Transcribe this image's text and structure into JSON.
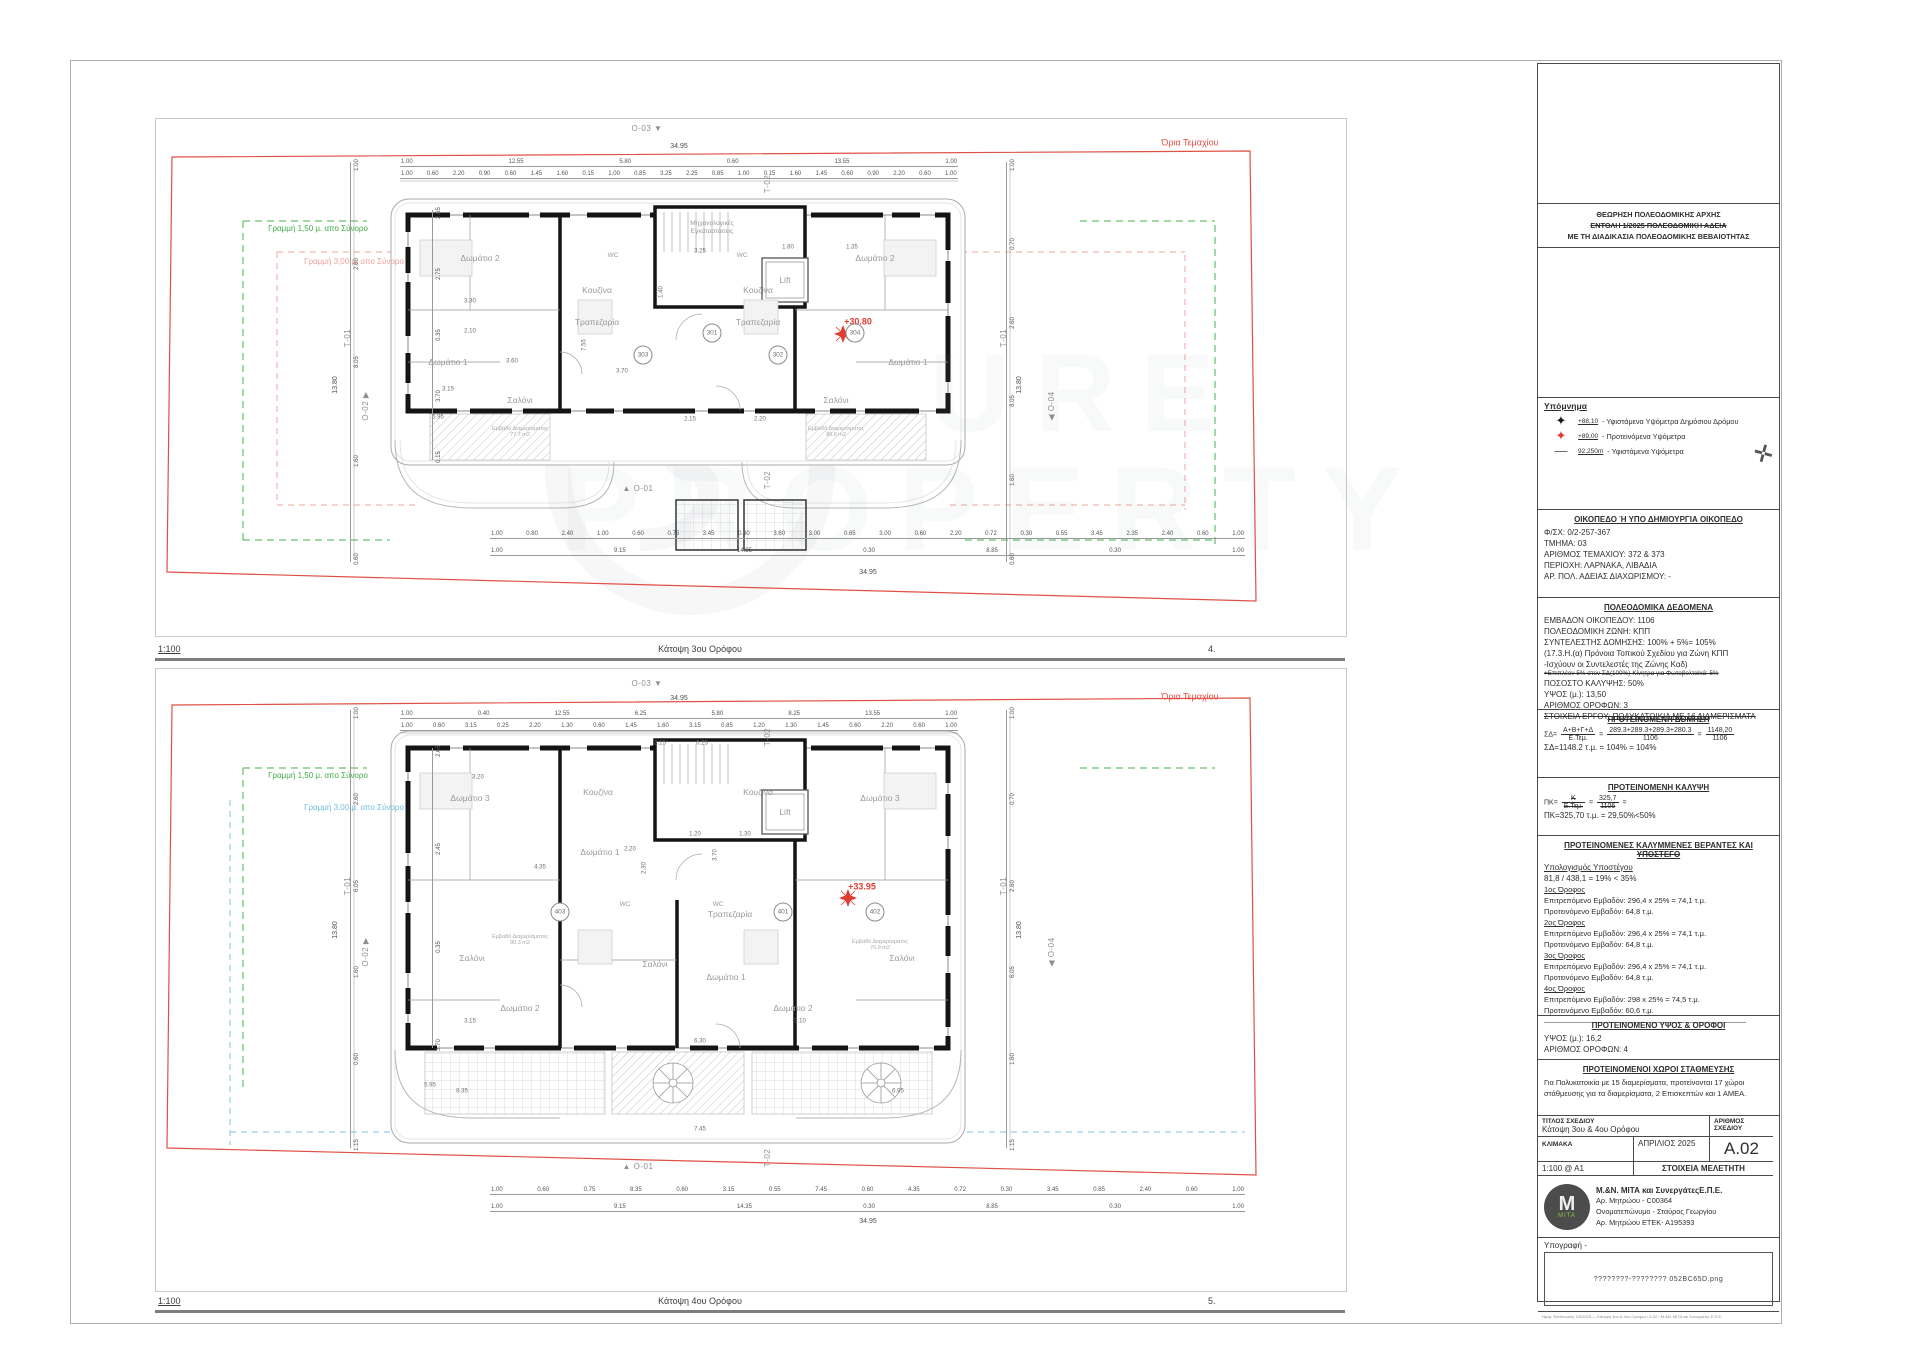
{
  "watermark": {
    "line1": "URE",
    "line2": "PROPERTY"
  },
  "captions": {
    "plan1": {
      "scale": "1:100",
      "title": "Κάτοψη 3ου Ορόφου",
      "number": "4."
    },
    "plan2": {
      "scale": "1:100",
      "title": "Κάτοψη 4ου Ορόφου",
      "number": "5."
    }
  },
  "markers": [
    {
      "t": "Ο-03  ▼",
      "x": 647,
      "y": 129
    },
    {
      "t": "Τ-02",
      "x": 768,
      "y": 184,
      "rot": -90
    },
    {
      "t": "Ο-02  ▶",
      "x": 366,
      "y": 406,
      "rot": -90
    },
    {
      "t": "Τ-01",
      "x": 348,
      "y": 338,
      "rot": -90
    },
    {
      "t": "Τ-01",
      "x": 1004,
      "y": 338,
      "rot": -90
    },
    {
      "t": "◀  Ο-04",
      "x": 1052,
      "y": 406,
      "rot": -90
    },
    {
      "t": "▲  Ο-01",
      "x": 638,
      "y": 489
    },
    {
      "t": "Τ-02",
      "x": 768,
      "y": 480,
      "rot": -90
    },
    {
      "t": "Ο-03  ▼",
      "x": 647,
      "y": 684
    },
    {
      "t": "Τ-02",
      "x": 768,
      "y": 737,
      "rot": -90
    },
    {
      "t": "Ο-02  ▶",
      "x": 366,
      "y": 952,
      "rot": -90
    },
    {
      "t": "Τ-01",
      "x": 348,
      "y": 886,
      "rot": -90
    },
    {
      "t": "Τ-01",
      "x": 1004,
      "y": 886,
      "rot": -90
    },
    {
      "t": "◀  Ο-04",
      "x": 1052,
      "y": 952,
      "rot": -90
    },
    {
      "t": "▲  Ο-01",
      "x": 638,
      "y": 1167
    },
    {
      "t": "Τ-02",
      "x": 768,
      "y": 1158,
      "rot": -90
    }
  ],
  "plan1": {
    "labels": [
      {
        "t": "Όρια Τεμαχίου",
        "x": 1190,
        "y": 143,
        "c": "redlbl"
      },
      {
        "t": "Γραμμή 1,50 μ. απο Σύνορο",
        "x": 318,
        "y": 229,
        "c": "greenlbl"
      },
      {
        "t": "Γραμμή 3,00 μ. απο Σύνορο",
        "x": 354,
        "y": 262,
        "c": "pinklbl"
      },
      {
        "t": "34.95",
        "x": 679,
        "y": 147,
        "c": "dimtot"
      },
      {
        "t": "34.95",
        "x": 868,
        "y": 573,
        "c": "dimtot"
      },
      {
        "t": "13.80",
        "x": 336,
        "y": 385,
        "c": "dimtot",
        "rot": -90
      },
      {
        "t": "13.80",
        "x": 1020,
        "y": 385,
        "c": "dimtot",
        "rot": -90
      },
      {
        "t": "Μηχανολογικές\nΕγκαταστάσεις",
        "x": 712,
        "y": 228,
        "c": "tinylbl"
      },
      {
        "t": "Lift",
        "x": 785,
        "y": 280,
        "c": "roomlbl"
      },
      {
        "t": "Δωμάτιο 2",
        "x": 480,
        "y": 258,
        "c": "roomlbl"
      },
      {
        "t": "Δωμάτιο 2",
        "x": 875,
        "y": 258,
        "c": "roomlbl"
      },
      {
        "t": "Δωμάτιο 1",
        "x": 448,
        "y": 362,
        "c": "roomlbl"
      },
      {
        "t": "Δωμάτιο 1",
        "x": 908,
        "y": 362,
        "c": "roomlbl"
      },
      {
        "t": "Κουζίνα",
        "x": 597,
        "y": 290,
        "c": "roomlbl"
      },
      {
        "t": "Κουζίνα",
        "x": 758,
        "y": 290,
        "c": "roomlbl"
      },
      {
        "t": "Τραπεζαρία",
        "x": 597,
        "y": 322,
        "c": "roomlbl"
      },
      {
        "t": "Τραπεζαρία",
        "x": 758,
        "y": 322,
        "c": "roomlbl"
      },
      {
        "t": "WC",
        "x": 613,
        "y": 256,
        "c": "tinylbl"
      },
      {
        "t": "WC",
        "x": 742,
        "y": 256,
        "c": "tinylbl"
      },
      {
        "t": "Σαλόνι",
        "x": 520,
        "y": 400,
        "c": "roomlbl"
      },
      {
        "t": "Σαλόνι",
        "x": 836,
        "y": 400,
        "c": "roomlbl"
      },
      {
        "t": "Εμβαδό Διαμερίσματος\n77.7 m2",
        "x": 520,
        "y": 432,
        "c": "arealbl"
      },
      {
        "t": "Εμβαδό Διαμερίσματος\n80.6 m2",
        "x": 836,
        "y": 432,
        "c": "arealbl"
      },
      {
        "t": "+30.80",
        "x": 858,
        "y": 322,
        "c": "levellbl"
      },
      {
        "t": "3.30",
        "x": 470,
        "y": 302,
        "c": "dimin"
      },
      {
        "t": "2.10",
        "x": 470,
        "y": 332,
        "c": "dimin"
      },
      {
        "t": "3.15",
        "x": 448,
        "y": 390,
        "c": "dimin"
      },
      {
        "t": "3.70",
        "x": 622,
        "y": 372,
        "c": "dimin"
      },
      {
        "t": "5.95",
        "x": 438,
        "y": 418,
        "c": "dimin"
      },
      {
        "t": "3.25",
        "x": 700,
        "y": 252,
        "c": "dimin"
      },
      {
        "t": "1.80",
        "x": 788,
        "y": 248,
        "c": "dimin"
      },
      {
        "t": "1.35",
        "x": 852,
        "y": 248,
        "c": "dimin"
      },
      {
        "t": "2.15",
        "x": 690,
        "y": 420,
        "c": "dimin"
      },
      {
        "t": "1.40",
        "x": 662,
        "y": 292,
        "c": "dimin",
        "rot": -90
      },
      {
        "t": "7.55",
        "x": 585,
        "y": 345,
        "c": "dimin",
        "rot": -90
      },
      {
        "t": "3.60",
        "x": 512,
        "y": 362,
        "c": "dimin"
      },
      {
        "t": "2.20",
        "x": 760,
        "y": 420,
        "c": "dimin"
      }
    ],
    "units": [
      {
        "t": "301",
        "x": 712,
        "y": 333
      },
      {
        "t": "302",
        "x": 778,
        "y": 355
      },
      {
        "t": "303",
        "x": 643,
        "y": 355
      },
      {
        "t": "304",
        "x": 855,
        "y": 333
      }
    ],
    "dimrows": [
      {
        "x": 400,
        "y": 158,
        "w": 558,
        "vals": [
          "1.00",
          "12.55",
          "5.80",
          "0.60",
          "13.55",
          "1.00"
        ]
      },
      {
        "x": 400,
        "y": 170,
        "w": 558,
        "vals": [
          "1.00",
          "0.60",
          "2.20",
          "0.90",
          "0.60",
          "1.45",
          "1.60",
          "0.15",
          "1.00",
          "0.85",
          "3.25",
          "2.25",
          "0.85",
          "1.00",
          "0.15",
          "1.60",
          "1.45",
          "0.60",
          "0.90",
          "2.20",
          "0.60",
          "1.00"
        ]
      },
      {
        "x": 490,
        "y": 530,
        "w": 755,
        "vals": [
          "1.00",
          "0.80",
          "2.40",
          "1.00",
          "0.60",
          "0.75",
          "3.45",
          "0.60",
          "3.60",
          "3.00",
          "0.65",
          "3.00",
          "0.60",
          "2.20",
          "0.72",
          "0.30",
          "0.55",
          "3.45",
          "2.35",
          "2.40",
          "0.60",
          "1.00"
        ]
      },
      {
        "x": 490,
        "y": 547,
        "w": 755,
        "vals": [
          "1.00",
          "9.15",
          "14.35",
          "0.30",
          "8.85",
          "0.30",
          "1.00"
        ]
      }
    ],
    "vdims": [
      {
        "x": 350,
        "y": 162,
        "h": 400,
        "vals": [
          "1.00",
          "2.60",
          "8.05",
          "1.60",
          "0.60"
        ]
      },
      {
        "x": 432,
        "y": 210,
        "h": 250,
        "vals": [
          "2.65",
          "2.75",
          "0.35",
          "3.70",
          "0.15"
        ]
      },
      {
        "x": 1006,
        "y": 162,
        "h": 400,
        "vals": [
          "1.00",
          "0.70",
          "2.60",
          "8.05",
          "1.60",
          "0.60"
        ]
      }
    ]
  },
  "plan2": {
    "labels": [
      {
        "t": "Όρια Τεμαχίου",
        "x": 1190,
        "y": 697,
        "c": "redlbl"
      },
      {
        "t": "Γραμμή 1,50 μ. απο Σύνορο",
        "x": 318,
        "y": 776,
        "c": "greenlbl"
      },
      {
        "t": "Γραμμή 3,00 μ. απο Σύνορο",
        "x": 354,
        "y": 808,
        "c": "bluelbl"
      },
      {
        "t": "34.95",
        "x": 679,
        "y": 699,
        "c": "dimtot"
      },
      {
        "t": "34.95",
        "x": 868,
        "y": 1222,
        "c": "dimtot"
      },
      {
        "t": "13.80",
        "x": 336,
        "y": 930,
        "c": "dimtot",
        "rot": -90
      },
      {
        "t": "13.80",
        "x": 1020,
        "y": 930,
        "c": "dimtot",
        "rot": -90
      },
      {
        "t": "Lift",
        "x": 785,
        "y": 812,
        "c": "roomlbl"
      },
      {
        "t": "Δωμάτιο 3",
        "x": 470,
        "y": 798,
        "c": "roomlbl"
      },
      {
        "t": "Δωμάτιο 3",
        "x": 880,
        "y": 798,
        "c": "roomlbl"
      },
      {
        "t": "Κουζίνα",
        "x": 598,
        "y": 792,
        "c": "roomlbl"
      },
      {
        "t": "Κουζίνα",
        "x": 758,
        "y": 792,
        "c": "roomlbl"
      },
      {
        "t": "Τραπεζαρία",
        "x": 730,
        "y": 914,
        "c": "roomlbl"
      },
      {
        "t": "WC",
        "x": 718,
        "y": 905,
        "c": "tinylbl"
      },
      {
        "t": "WC",
        "x": 625,
        "y": 905,
        "c": "tinylbl"
      },
      {
        "t": "Σαλόνι",
        "x": 472,
        "y": 958,
        "c": "roomlbl"
      },
      {
        "t": "Σαλόνι",
        "x": 655,
        "y": 964,
        "c": "roomlbl"
      },
      {
        "t": "Σαλόνι",
        "x": 902,
        "y": 958,
        "c": "roomlbl"
      },
      {
        "t": "Δωμάτιο 1",
        "x": 600,
        "y": 852,
        "c": "roomlbl"
      },
      {
        "t": "Δωμάτιο 1",
        "x": 726,
        "y": 977,
        "c": "roomlbl"
      },
      {
        "t": "Δωμάτιο 2",
        "x": 520,
        "y": 1008,
        "c": "roomlbl"
      },
      {
        "t": "Δωμάτιο 2",
        "x": 793,
        "y": 1008,
        "c": "roomlbl"
      },
      {
        "t": "Εμβαδό Διαμερίσματος\n90.3 m2",
        "x": 520,
        "y": 940,
        "c": "arealbl"
      },
      {
        "t": "Εμβαδό Διαμερίσματος\n76.9 m2",
        "x": 880,
        "y": 945,
        "c": "arealbl"
      },
      {
        "t": "+33.95",
        "x": 862,
        "y": 887,
        "c": "levellbl"
      },
      {
        "t": "3.15",
        "x": 660,
        "y": 744,
        "c": "dimin"
      },
      {
        "t": "0.25",
        "x": 702,
        "y": 744,
        "c": "dimin"
      },
      {
        "t": "3.20",
        "x": 478,
        "y": 778,
        "c": "dimin"
      },
      {
        "t": "3.70",
        "x": 716,
        "y": 855,
        "c": "dimin",
        "rot": -90
      },
      {
        "t": "2.20",
        "x": 630,
        "y": 850,
        "c": "dimin"
      },
      {
        "t": "6.30",
        "x": 700,
        "y": 1042,
        "c": "dimin"
      },
      {
        "t": "8.35",
        "x": 462,
        "y": 1092,
        "c": "dimin"
      },
      {
        "t": "6.95",
        "x": 898,
        "y": 1092,
        "c": "dimin"
      },
      {
        "t": "5.95",
        "x": 430,
        "y": 1086,
        "c": "dimin"
      },
      {
        "t": "3.15",
        "x": 470,
        "y": 1022,
        "c": "dimin"
      },
      {
        "t": "3.10",
        "x": 800,
        "y": 1022,
        "c": "dimin"
      },
      {
        "t": "2.30",
        "x": 645,
        "y": 868,
        "c": "dimin",
        "rot": -90
      },
      {
        "t": "7.45",
        "x": 700,
        "y": 1130,
        "c": "dimin"
      },
      {
        "t": "4.35",
        "x": 540,
        "y": 868,
        "c": "dimin"
      },
      {
        "t": "1.20",
        "x": 695,
        "y": 835,
        "c": "dimin"
      },
      {
        "t": "1.30",
        "x": 745,
        "y": 835,
        "c": "dimin"
      }
    ],
    "units": [
      {
        "t": "401",
        "x": 783,
        "y": 912
      },
      {
        "t": "402",
        "x": 875,
        "y": 912
      },
      {
        "t": "403",
        "x": 560,
        "y": 912
      }
    ],
    "dimrows": [
      {
        "x": 400,
        "y": 710,
        "w": 558,
        "vals": [
          "1.00",
          "0.40",
          "12.55",
          "6.25",
          "5.80",
          "8.25",
          "13.55",
          "1.00"
        ]
      },
      {
        "x": 400,
        "y": 722,
        "w": 558,
        "vals": [
          "1.00",
          "0.60",
          "3.15",
          "0.25",
          "2.20",
          "1.30",
          "0.60",
          "1.45",
          "1.60",
          "3.15",
          "0.85",
          "1.20",
          "1.30",
          "1.45",
          "0.60",
          "2.20",
          "0.60",
          "1.00"
        ]
      },
      {
        "x": 490,
        "y": 1186,
        "w": 755,
        "vals": [
          "1.00",
          "0.60",
          "0.75",
          "8.35",
          "0.60",
          "3.15",
          "0.55",
          "7.45",
          "0.60",
          "4.35",
          "0.72",
          "0.30",
          "3.45",
          "0.85",
          "2.40",
          "0.60",
          "1.00"
        ]
      },
      {
        "x": 490,
        "y": 1203,
        "w": 755,
        "vals": [
          "1.00",
          "9.15",
          "14.35",
          "0.30",
          "8.85",
          "0.30",
          "1.00"
        ]
      }
    ],
    "vdims": [
      {
        "x": 350,
        "y": 710,
        "h": 438,
        "vals": [
          "1.00",
          "2.60",
          "6.05",
          "1.60",
          "0.60",
          "1.15"
        ]
      },
      {
        "x": 432,
        "y": 748,
        "h": 300,
        "vals": [
          "2.65",
          "2.45",
          "0.35",
          "3.70"
        ]
      },
      {
        "x": 1006,
        "y": 710,
        "h": 438,
        "vals": [
          "1.00",
          "0.70",
          "2.60",
          "6.05",
          "1.60",
          "1.15"
        ]
      }
    ]
  },
  "titleblock": {
    "approval": [
      {
        "t": "ΘΕΩΡΗΣΗ ΠΟΛΕΟΔΟΜΙΚΗΣ ΑΡΧΗΣ"
      },
      {
        "t": "ΕΝΤΟΛΗ 1/2025 ΠΟΛΕΟΔΟΜΙΚΗ ΑΔΕΙΑ",
        "strike": true
      },
      {
        "t": "ΜΕ ΤΗ ΔΙΑΔΙΚΑΣΙΑ ΠΟΛΕΟΔΟΜΙΚΗΣ ΒΕΒΑΙΟΤΗΤΑΣ"
      }
    ],
    "legend": {
      "title": "Υπόμνημα",
      "items": [
        {
          "sym": "✦",
          "symcolor": "#1a1a1a",
          "val": "+88,10",
          "desc": "- Υφιστάμενα Υψόμετρα Δημόσιου Δρόμου"
        },
        {
          "sym": "✦",
          "symcolor": "#e03c31",
          "val": "+89,00",
          "desc": "- Προτεινόμενα Υψόμετρα"
        },
        {
          "sym": "—",
          "symcolor": "#555555",
          "val": "92.250m",
          "desc": "- Υφιστάμενα Υψόμετρα"
        }
      ]
    },
    "plot": {
      "header": "ΟΙΚΟΠΕΔΟ Ή ΥΠΟ ΔΗΜΙΟΥΡΓΙΑ ΟΙΚΟΠΕΔΟ",
      "lines": [
        {
          "t": "Φ/ΣΧ: 0/2-257-367"
        },
        {
          "t": "ΤΜΗΜΑ: 03"
        },
        {
          "t": "ΑΡΙΘΜΟΣ ΤΕΜΑΧΙΟΥ: 372 & 373"
        },
        {
          "t": "ΠΕΡΙΟΧΗ: ΛΑΡΝΑΚΑ, ΛΙΒΑΔΙΑ"
        },
        {
          "t": "ΑΡ. ΠΟΛ. ΑΔΕΙΑΣ ΔΙΑΧΩΡΙΣΜΟΥ: -"
        }
      ]
    },
    "zoning": {
      "header": "ΠΟΛΕΟΔΟΜΙΚΑ ΔΕΔΟΜΕΝΑ",
      "lines": [
        {
          "t": "ΕΜΒΑΔΟΝ ΟΙΚΟΠΕΔΟΥ: 1106"
        },
        {
          "t": "ΠΟΛΕΟΔΟΜΙΚΗ ΖΩΝΗ: ΚΠΠ"
        },
        {
          "t": "ΣΥΝΤΕΛΕΣΤΗΣ ΔΟΜΗΣΗΣ: 100% + 5%= 105%"
        },
        {
          "t": "(17.3.Η.(α) Πρόνοια Τοπικού Σχεδίου για Ζώνη ΚΠΠ"
        },
        {
          "t": "-Ισχύουν οι Συντελεστές της Ζώνης Καδ)"
        },
        {
          "t": "+Επιπλέον 5% στον ΣΔ(100%)-Κίνητρα για Φωτοβολταϊκά: 5%",
          "small": true,
          "strike": true
        },
        {
          "t": "ΠΟΣΟΣΤΟ ΚΑΛΥΨΗΣ: 50%"
        },
        {
          "t": "ΥΨΟΣ (μ.): 13,50"
        },
        {
          "t": "ΑΡΙΘΜΟΣ ΟΡΟΦΩΝ: 3"
        },
        {
          "t": "ΣΤΟΙΧΕΙΑ ΕΡΓΟΥ: ΠΟΛΥΚΑΤΟΙΚΙΑ ΜΕ 16 ΔΙΑΜΕΡΙΣΜΑΤΑ",
          "strike": true
        }
      ]
    },
    "domisi": {
      "header": "ΠΡΟΤΕΙΝΟΜΕΝΗ ΔΟΜΗΣΗ",
      "sd": "ΣΔ=",
      "f1n": "Α+Β+Γ+Δ",
      "f1d": "Ε.Τεμ.",
      "eq1": "=",
      "f2n": "289.3+289.3+289.3+280.3",
      "f2d": "1106",
      "eq2": "=",
      "f3n": "1148,20",
      "f3d": "1106",
      "result": "ΣΔ=1148.2 τ.μ. = 104% = 104%"
    },
    "kalypsi": {
      "header": "ΠΡΟΤΕΙΝΟΜΕΝΗ ΚΑΛΥΨΗ",
      "pk": "ΠΚ=",
      "f1n": "Κ",
      "f1d": "Ε.Τεμ.",
      "eq1": "=",
      "f2n": "325,7",
      "f2d": "1106",
      "eq2": "=",
      "result": "ΠΚ=325,70 τ.μ. = 29,50%<50%"
    },
    "verandas": {
      "header1": "ΠΡΟΤΕΙΝΟΜΕΝΕΣ ΚΑΛΥΜΜΕΝΕΣ ΒΕΡΑΝΤΕΣ ΚΑΙ",
      "header2": "ΥΠΟΣΤΕΓΟ",
      "calc_title": "Υπολογισμός Υποστέγου",
      "calc": "81,8 / 438,1 = 19% < 35%",
      "floors": [
        {
          "name": "1ος Όροφος",
          "allowed": "Επιτρεπόμενο Εμβαδόν: 296,4 x 25% = 74,1 τ.μ.",
          "proposed": "Προτεινόμενο Εμβαδόν: 64,8 τ.μ."
        },
        {
          "name": "2ος Όροφος",
          "allowed": "Επιτρεπόμενο Εμβαδόν: 296,4 x 25% = 74,1 τ.μ.",
          "proposed": "Προτεινόμενο Εμβαδόν: 64,8 τ.μ."
        },
        {
          "name": "3ος Όροφος",
          "allowed": "Επιτρεπόμενο Εμβαδόν: 296,4 x 25% = 74,1 τ.μ.",
          "proposed": "Προτεινόμενο Εμβαδόν: 64,8 τ.μ."
        },
        {
          "name": "4ος Όροφος",
          "allowed": "Επιτρεπόμενο Εμβαδόν: 298 x 25% = 74,5 τ.μ.",
          "proposed": "Προτεινόμενο Εμβαδόν: 60,6 τ.μ."
        }
      ]
    },
    "height": {
      "header": "ΠΡΟΤΕΙΝΟΜΕΝΟ ΥΨΟΣ & ΟΡΟΦΟΙ",
      "lines": [
        {
          "t": "ΥΨΟΣ (μ.): 16,2"
        },
        {
          "t": "ΑΡΙΘΜΟΣ ΟΡΟΦΩΝ: 4"
        }
      ]
    },
    "parking": {
      "header": "ΠΡΟΤΕΙΝΟΜΕΝΟΙ ΧΩΡΟΙ ΣΤΑΘΜΕΥΣΗΣ",
      "text": "Για Πολυκατοικία με 15 διαμερίσματα, προτείνονται 17 χώροι στάθμευσης για τα διαμερίσματα, 2 Επισκεπτών και 1 ΑΜΕΑ."
    },
    "drawing": {
      "title_label": "ΤΙΤΛΟΣ ΣΧΕΔΙΟΥ",
      "title_value": "Κάτοψη 3ου & 4ου Ορόφου",
      "number_label": "ΑΡΙΘΜΟΣ ΣΧΕΔΙΟΥ",
      "number_value": "A.02",
      "scale_label": "ΚΛΙΜΑΚΑ",
      "date": "ΑΠΡΙΛΙΟΣ 2025",
      "scale_value": "1:100 @ A1",
      "designer_label": "ΣΤΟΙΧΕΙΑ ΜΕΛΕΤΗΤΗ"
    },
    "designer": {
      "logo_m": "M",
      "logo_text": "MITA",
      "name": "Μ.&Ν. ΜΙΤΑ και ΣυνεργάτεςΕ.Π.Ε.",
      "lines": [
        {
          "t": "Αρ. Μητρώου - C00364"
        },
        {
          "t": "Ονοματεπώνυμο - Σταύρος Γεωργίου"
        },
        {
          "t": "Αρ. Μητρώου ΕΤΕΚ- Α195393"
        }
      ]
    },
    "signature": {
      "label": "Υπογραφή -",
      "placeholder": "????????-???????? 052BC65D.png"
    },
    "fineprint": "Ημερ. Εκτύπωσης 1/9/2025 — Κάτοψη 3ου & 4ου Ορόφου / Α.02 / Μ.&Ν. ΜΙΤΑ και Συνεργάτες Ε.Π.Ε."
  }
}
